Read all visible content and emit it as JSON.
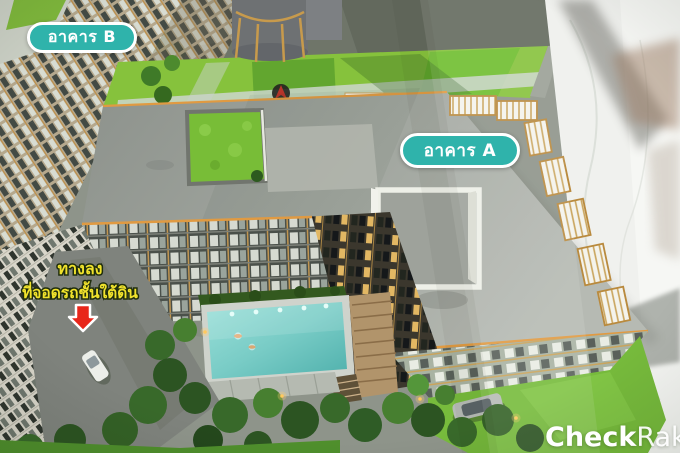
{
  "scene": {
    "building_b_label": "อาคาร B",
    "building_a_label": "อาคาร A",
    "ramp_annotation": {
      "line1": "ทางลง",
      "line2": "ที่จอดรถชั้นใต้ดิน"
    },
    "compass_label": "N"
  },
  "watermark": {
    "bold_part": "Check",
    "light_part": "Raka"
  },
  "colors": {
    "badge_teal": "#2fb3ab",
    "badge_border": "#ffffff",
    "note_yellow": "#f0e22c",
    "arrow_red": "#e8261a",
    "lawn_green": "#86c23c",
    "roof_grey": "#9a9e99",
    "pool_teal": "#79ccc6",
    "marble_white": "#f0f1ee",
    "gold_trim": "#c79a4c"
  }
}
